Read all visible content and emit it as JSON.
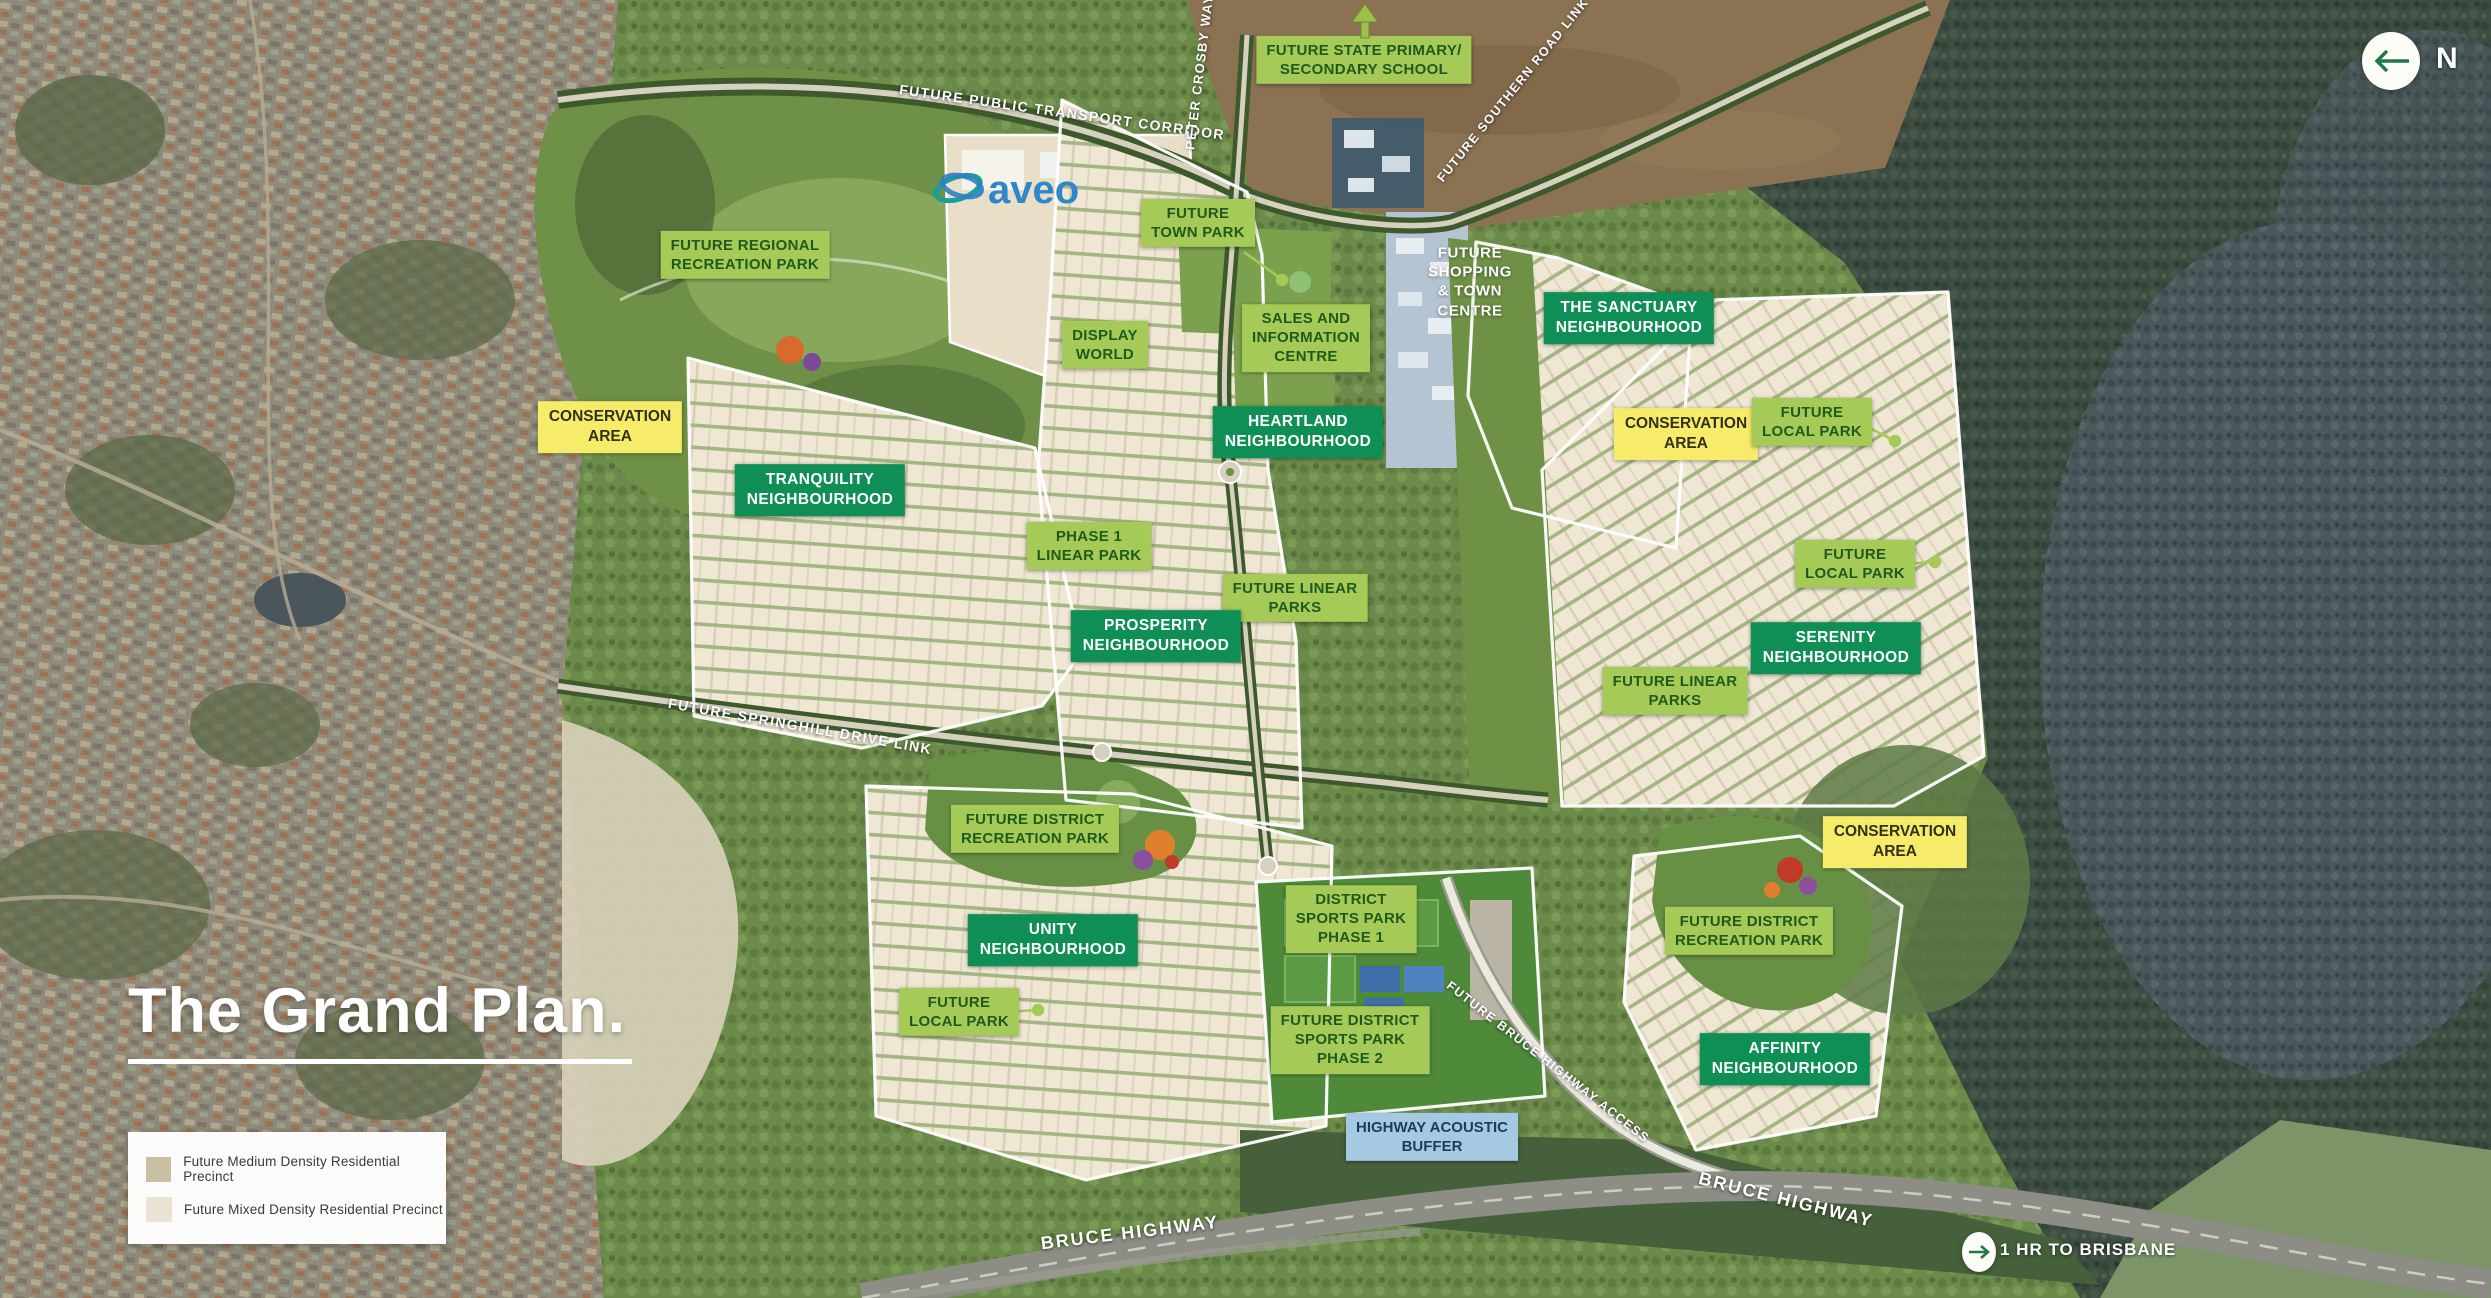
{
  "title": "The Grand Plan.",
  "brand": "aveo",
  "compass": {
    "label": "N"
  },
  "badges": {
    "brisbane": "1 HR TO BRISBANE"
  },
  "legend": {
    "items": [
      {
        "label": "Future Medium Density Residential Precinct",
        "swatch": "#c8bfa5"
      },
      {
        "label": "Future Mixed Density Residential Precinct",
        "swatch": "#eae3d3"
      }
    ]
  },
  "colors": {
    "label_light": "#a6ca58",
    "label_light_text": "#1f5a1d",
    "label_dark": "#0f8f55",
    "label_dark_text": "#ffffff",
    "label_yellow": "#f6ec69",
    "label_yellow_text": "#33301d",
    "label_blue": "#a5c9e3",
    "label_blue_text": "#1d3d56",
    "road_text": "#ffffff",
    "title_text": "#ffffff",
    "aveo_blue": "#2f86c9",
    "aveo_teal": "#1b9e9a",
    "arrow_green": "#1e7a4a"
  },
  "labels": {
    "school": "FUTURE STATE PRIMARY/\nSECONDARY SCHOOL",
    "transport_corridor": "FUTURE PUBLIC TRANSPORT CORRIDOR",
    "peter_crosby_way": "PETER CROSBY WAY",
    "southern_road_link": "FUTURE SOUTHERN ROAD LINK",
    "town_park": "FUTURE\nTOWN PARK",
    "shopping_centre": "FUTURE\nSHOPPING\n& TOWN\nCENTRE",
    "sanctuary": "THE SANCTUARY\nNEIGHBOURHOOD",
    "sales_centre": "SALES AND\nINFORMATION\nCENTRE",
    "display_world": "DISPLAY\nWORLD",
    "heartland": "HEARTLAND\nNEIGHBOURHOOD",
    "regional_recreation_park": "FUTURE REGIONAL\nRECREATION PARK",
    "conservation_west": "CONSERVATION\nAREA",
    "conservation_northeast": "CONSERVATION\nAREA",
    "conservation_southeast": "CONSERVATION\nAREA",
    "local_park_northeast": "FUTURE\nLOCAL PARK",
    "local_park_east": "FUTURE\nLOCAL PARK",
    "local_park_south": "FUTURE\nLOCAL PARK",
    "tranquility": "TRANQUILITY\nNEIGHBOURHOOD",
    "phase1_linear_park": "PHASE 1\nLINEAR PARK",
    "linear_parks_central": "FUTURE LINEAR\nPARKS",
    "linear_parks_east": "FUTURE LINEAR\nPARKS",
    "prosperity": "PROSPERITY\nNEIGHBOURHOOD",
    "serenity": "SERENITY\nNEIGHBOURHOOD",
    "springhill_drive": "FUTURE SPRINGHILL DRIVE LINK",
    "district_recreation_park_west": "FUTURE DISTRICT\nRECREATION PARK",
    "district_recreation_park_east": "FUTURE DISTRICT\nRECREATION PARK",
    "unity": "UNITY\nNEIGHBOURHOOD",
    "district_sports_phase1": "DISTRICT\nSPORTS PARK\nPHASE 1",
    "district_sports_phase2": "FUTURE DISTRICT\nSPORTS PARK\nPHASE 2",
    "acoustic_buffer": "HIGHWAY ACOUSTIC\nBUFFER",
    "bruce_highway_access": "FUTURE BRUCE HIGHWAY ACCESS",
    "affinity": "AFFINITY\nNEIGHBOURHOOD",
    "bruce_highway_left": "BRUCE HIGHWAY",
    "bruce_highway_right": "BRUCE HIGHWAY"
  }
}
